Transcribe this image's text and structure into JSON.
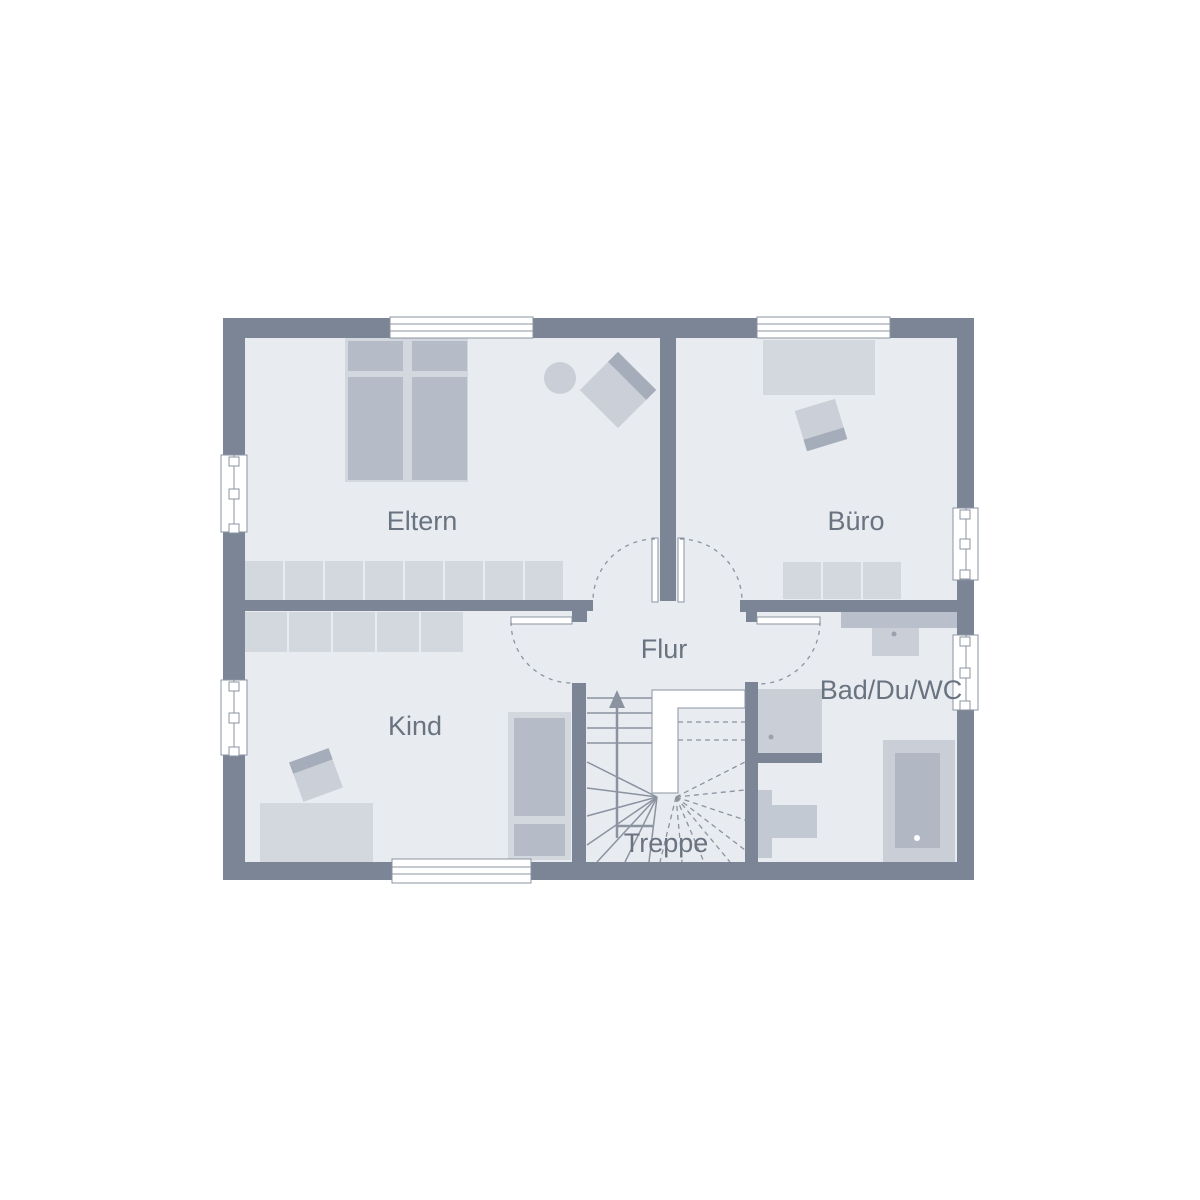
{
  "plan": {
    "type": "floor-plan",
    "rooms": [
      {
        "id": "eltern",
        "label": "Eltern"
      },
      {
        "id": "buero",
        "label": "Büro"
      },
      {
        "id": "kind",
        "label": "Kind"
      },
      {
        "id": "flur",
        "label": "Flur"
      },
      {
        "id": "bad",
        "label": "Bad/Du/WC"
      },
      {
        "id": "treppe",
        "label": "Treppe"
      }
    ]
  },
  "colors": {
    "background": "#ffffff",
    "wall": "#7b8596",
    "floor": "#e8ebf0",
    "furniture_light": "#d3d7de",
    "furniture_mid": "#b5bcc8",
    "chair_body": "#cbd0d8",
    "chair_accent": "#a5acba",
    "fixture": "#cacfd7",
    "fixture_dark": "#b1b8c4",
    "toilet": "#c3c9d2",
    "counter": "#b9c0cb",
    "line": "#8b93a1",
    "label_text": "#6a7380"
  }
}
